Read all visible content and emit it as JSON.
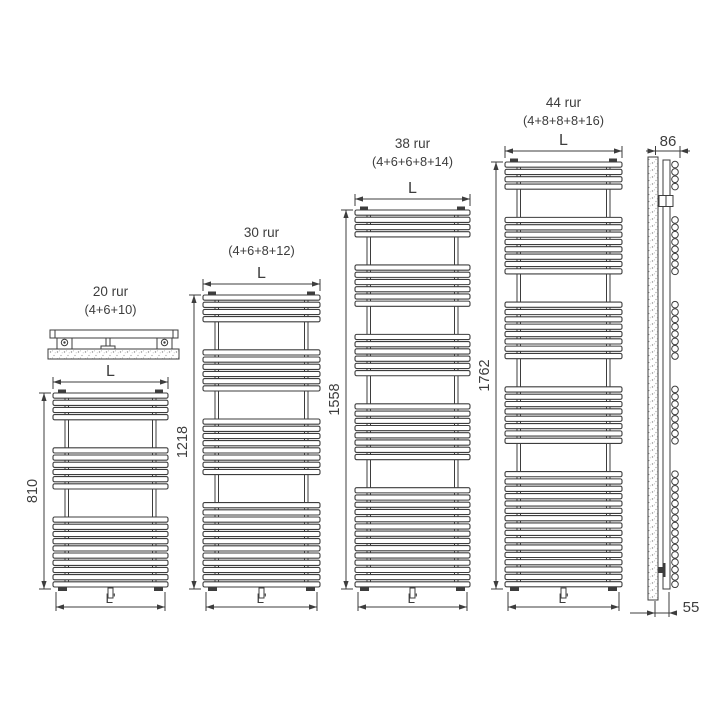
{
  "page": {
    "background": "#ffffff",
    "line_color": "#3d3d3d"
  },
  "dim_labels": {
    "width_top": "L",
    "width_bottom": "L'"
  },
  "radiators": [
    {
      "name": "20 rur",
      "formula": "(4+6+10)",
      "tube_groups": [
        4,
        6,
        10
      ],
      "height_mm": "810"
    },
    {
      "name": "30 rur",
      "formula": "(4+6+8+12)",
      "tube_groups": [
        4,
        6,
        8,
        12
      ],
      "height_mm": "1218"
    },
    {
      "name": "38 rur",
      "formula": "(4+6+6+8+14)",
      "tube_groups": [
        4,
        6,
        6,
        8,
        14
      ],
      "height_mm": "1558"
    },
    {
      "name": "44 rur",
      "formula": "(4+8+8+8+16)",
      "tube_groups": [
        4,
        8,
        8,
        8,
        16
      ],
      "height_mm": "1762"
    }
  ],
  "side_view": {
    "depth_mm": "86",
    "wall_distance_mm": "55",
    "tube_groups": [
      4,
      8,
      8,
      8,
      16
    ]
  }
}
